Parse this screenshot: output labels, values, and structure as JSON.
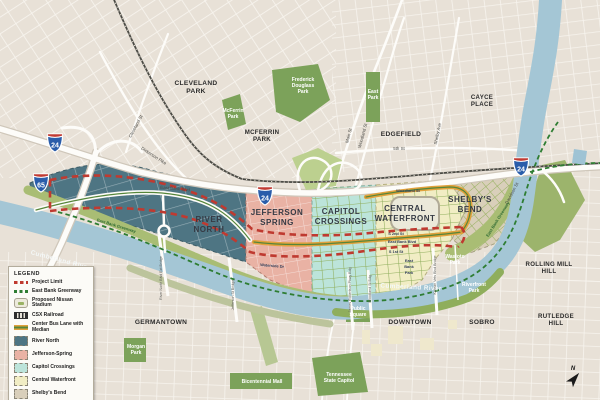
{
  "legend": {
    "title": "LEGEND",
    "items": [
      {
        "label": "Project Limit",
        "swatch": "project-limit"
      },
      {
        "label": "East Bank Greenway",
        "swatch": "east-bank-greenway"
      },
      {
        "label": "Proposed Nissan Stadium",
        "swatch": "proposed-nissan-stadium"
      },
      {
        "label": "CSX Railroad",
        "swatch": "csx-railroad"
      },
      {
        "label": "Center Bus Lane with Median",
        "swatch": "center-bus-lane-with-median"
      },
      {
        "label": "River North",
        "swatch": "river-north"
      },
      {
        "label": "Jefferson-Spring",
        "swatch": "jefferson-spring"
      },
      {
        "label": "Capitol Crossings",
        "swatch": "capitol-crossings"
      },
      {
        "label": "Central Waterfront",
        "swatch": "central-waterfront"
      },
      {
        "label": "Shelby's Bend",
        "swatch": "shelbys-bend"
      }
    ]
  },
  "districts": {
    "river_north": {
      "lines": [
        "RIVER",
        "NORTH"
      ]
    },
    "jefferson_spring": {
      "lines": [
        "JEFFERSON",
        "SPRING"
      ]
    },
    "capitol_crossings": {
      "lines": [
        "CAPITOL",
        "CROSSINGS"
      ]
    },
    "central_waterfront": {
      "lines": [
        "CENTRAL",
        "WATERFRONT"
      ]
    },
    "shelbys_bend": {
      "lines": [
        "SHELBY'S",
        "BEND"
      ]
    }
  },
  "neighborhoods": {
    "cleveland_park": {
      "lines": [
        "CLEVELAND",
        "PARK"
      ]
    },
    "mcferrin_park": {
      "lines": [
        "MCFERRIN",
        "PARK"
      ]
    },
    "edgefield": {
      "lines": [
        "EDGEFIELD"
      ]
    },
    "cayce_place": {
      "lines": [
        "CAYCE",
        "PLACE"
      ]
    },
    "germantown": {
      "lines": [
        "GERMANTOWN"
      ]
    },
    "downtown": {
      "lines": [
        "DOWNTOWN"
      ]
    },
    "sobro": {
      "lines": [
        "SOBRO"
      ]
    },
    "rutledge_hill": {
      "lines": [
        "RUTLEDGE",
        "HILL"
      ]
    },
    "rolling_mill_hill": {
      "lines": [
        "ROLLING MILL",
        "HILL"
      ]
    }
  },
  "parks": {
    "mcferrin": {
      "lines": [
        "McFerrin",
        "Park"
      ]
    },
    "frederick_douglass": {
      "lines": [
        "Frederick",
        "Douglass",
        "Park"
      ]
    },
    "east_park": {
      "lines": [
        "East",
        "Park"
      ]
    },
    "morgan": {
      "lines": [
        "Morgan",
        "Park"
      ]
    },
    "bicentennial_mall": {
      "lines": [
        "Bicentennial Mall"
      ]
    },
    "tn_state_capitol": {
      "lines": [
        "Tennessee",
        "State Capitol"
      ]
    },
    "public_square": {
      "lines": [
        "Public",
        "Square"
      ]
    },
    "riverfront": {
      "lines": [
        "Riverfront",
        "Park"
      ]
    },
    "wasioto": {
      "lines": [
        "Wasioto",
        "Park"
      ]
    },
    "east_bank_park": {
      "lines": [
        "East",
        "Bank",
        "Park"
      ]
    }
  },
  "streets": {
    "cleveland_st": "Cleveland St",
    "dickerson_pike": "Dickerson Pike",
    "main_st": "Main St",
    "woodland_st": "Woodland St",
    "shelby_ave": "Shelby Ave",
    "fifth_st": "5th St",
    "east_bank_blvd_rn": "East Bank Blvd",
    "east_bank_blvd_cw": "East Bank Blvd",
    "s_2nd_st": "S 2nd St",
    "s_1st_st": "S 1st St",
    "waterside_dr": "Waterside Dr",
    "davidson_st": "Davidson St",
    "woodland_st_transit": "Woodland St"
  },
  "river_labels": {
    "west": "Cumberland River",
    "east": "Cumberland River"
  },
  "greenway_labels": {
    "west": "East Bank Greenway",
    "east": "East Bank Greenway"
  },
  "bridges": {
    "river_north_blvd": "River North Blvd Ext Bridge",
    "jefferson_st": "Jefferson St Bridge",
    "james_robertson": "James Robertson Pkwy Bdg",
    "woodland": "Woodland St Bdg",
    "korean_vets": "Korean Vets Blvd Bridge"
  },
  "shields": {
    "i24_nw": "24",
    "i65": "65",
    "i24_mid": "24",
    "i24_e": "24"
  },
  "compass": {
    "north": "N"
  },
  "colors": {
    "base_land": "#e8e1d7",
    "river": "#a4c6d5",
    "park_green": "#7ca25a",
    "greenway_band": "#a9bd74",
    "river_north_fill": "#4e7583",
    "jefferson_spring_fill": "#e9b2a4",
    "capitol_crossings_fill": "#bce4da",
    "central_waterfront_fill": "#f1edc4",
    "shelbys_bend_fill": "#d9cfba",
    "project_limit_red": "#bf3a30",
    "greenway_green": "#2e7d32",
    "bus_lane_orange": "#e1a13b",
    "interstate_blue": "#2a5daa",
    "interstate_red": "#c13a32"
  }
}
